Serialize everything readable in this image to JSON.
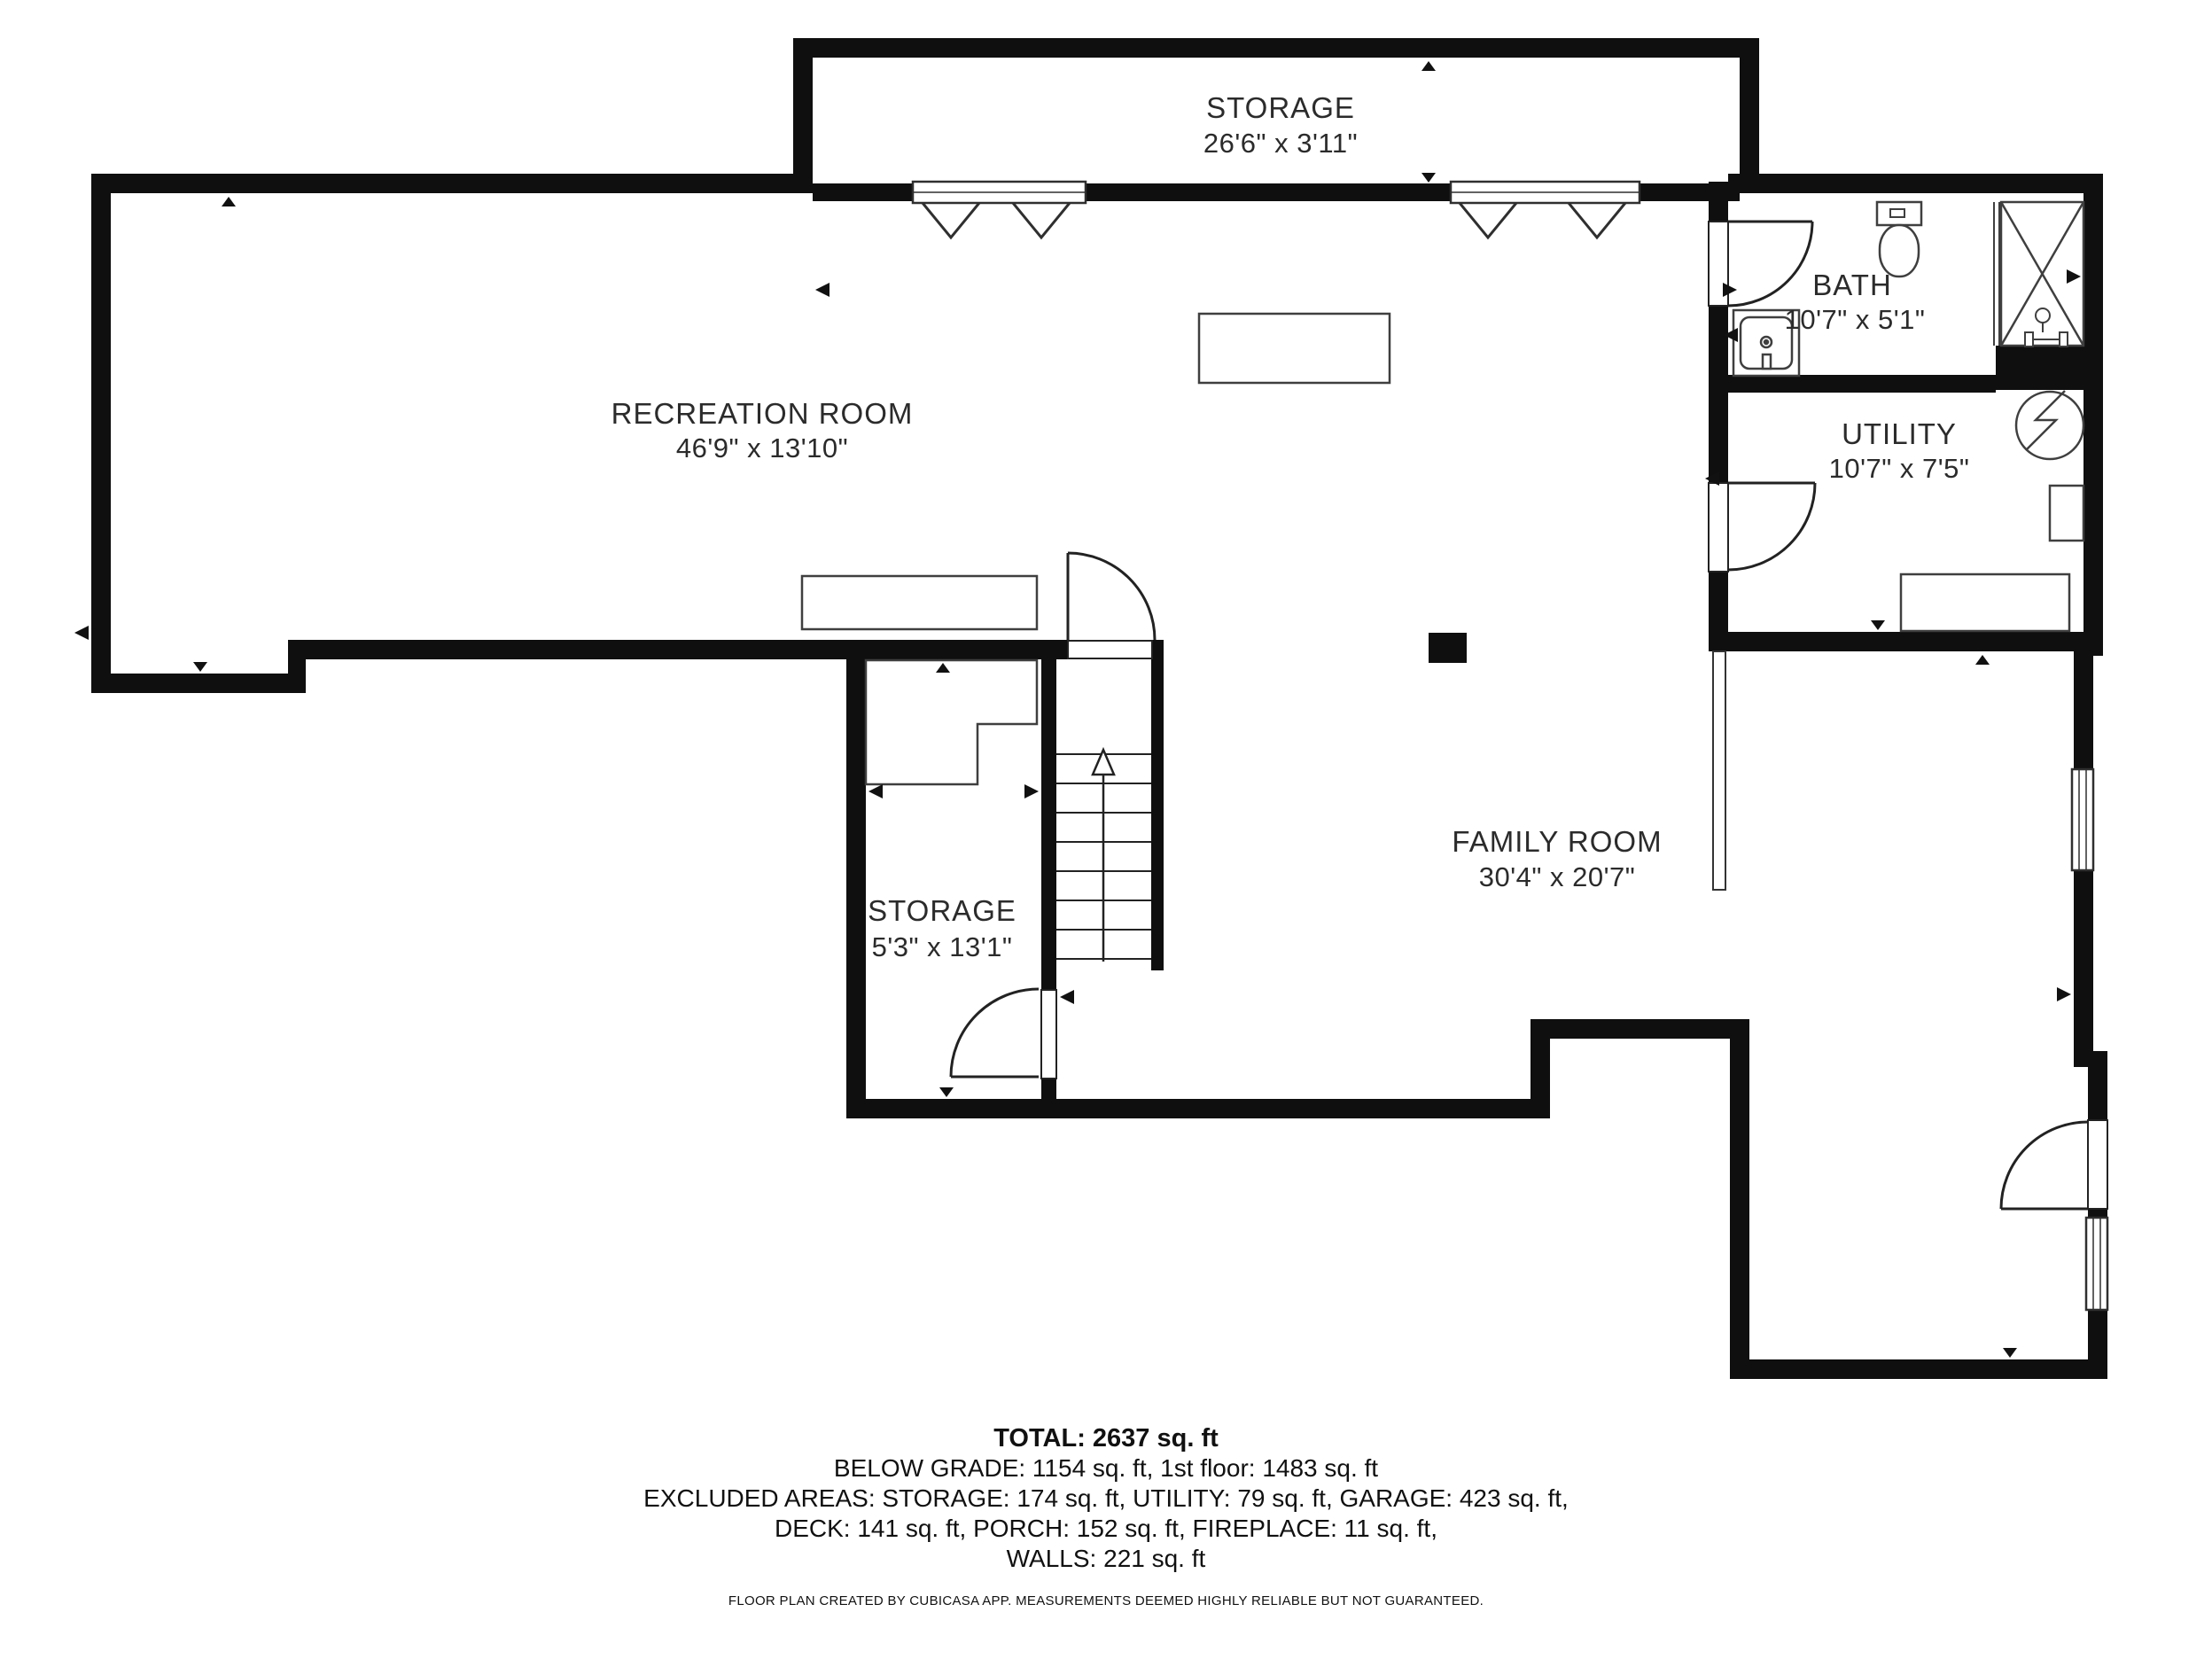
{
  "rooms": [
    {
      "name": "STORAGE",
      "dims": "26'6\" x 3'11\""
    },
    {
      "name": "RECREATION ROOM",
      "dims": "46'9\" x 13'10\""
    },
    {
      "name": "BATH",
      "dims": "10'7\" x 5'1\""
    },
    {
      "name": "UTILITY",
      "dims": "10'7\" x 7'5\""
    },
    {
      "name": "STORAGE",
      "dims": "5'3\" x 13'1\""
    },
    {
      "name": "FAMILY ROOM",
      "dims": "30'4\" x 20'7\""
    }
  ],
  "summary": {
    "total": "TOTAL: 2637 sq. ft",
    "below_grade": "BELOW GRADE: 1154 sq. ft, 1st floor: 1483 sq. ft",
    "excluded1": "EXCLUDED AREAS: STORAGE: 174 sq. ft, UTILITY: 79 sq. ft, GARAGE: 423 sq. ft,",
    "excluded2": "DECK: 141 sq. ft, PORCH: 152 sq. ft, FIREPLACE: 11 sq. ft,",
    "walls": "WALLS: 221 sq. ft"
  },
  "footer": "FLOOR PLAN CREATED BY CUBICASA APP. MEASUREMENTS DEEMED HIGHLY RELIABLE BUT NOT GUARANTEED.",
  "icons": {
    "toilet-icon": "tank + bowl outline",
    "sink-vanity-icon": "square vanity with round basin",
    "shower-icon": "box with X",
    "shower-head-icon": "head on stem over bar",
    "water-heater-icon": "circle with zigzag",
    "stairs-up-arrow-icon": "arrow pointing up stairs",
    "door-swing-icon": "quarter-circle arc",
    "window-icon": "white band in wall",
    "opening-chevron-icon": "V notch under wall",
    "direction-marker-icon": "small filled triangle"
  },
  "colors": {
    "wall": "#0f0f0f",
    "fixture_line": "#3f3f3f",
    "text": "#2b2b2b",
    "background": "#ffffff"
  }
}
